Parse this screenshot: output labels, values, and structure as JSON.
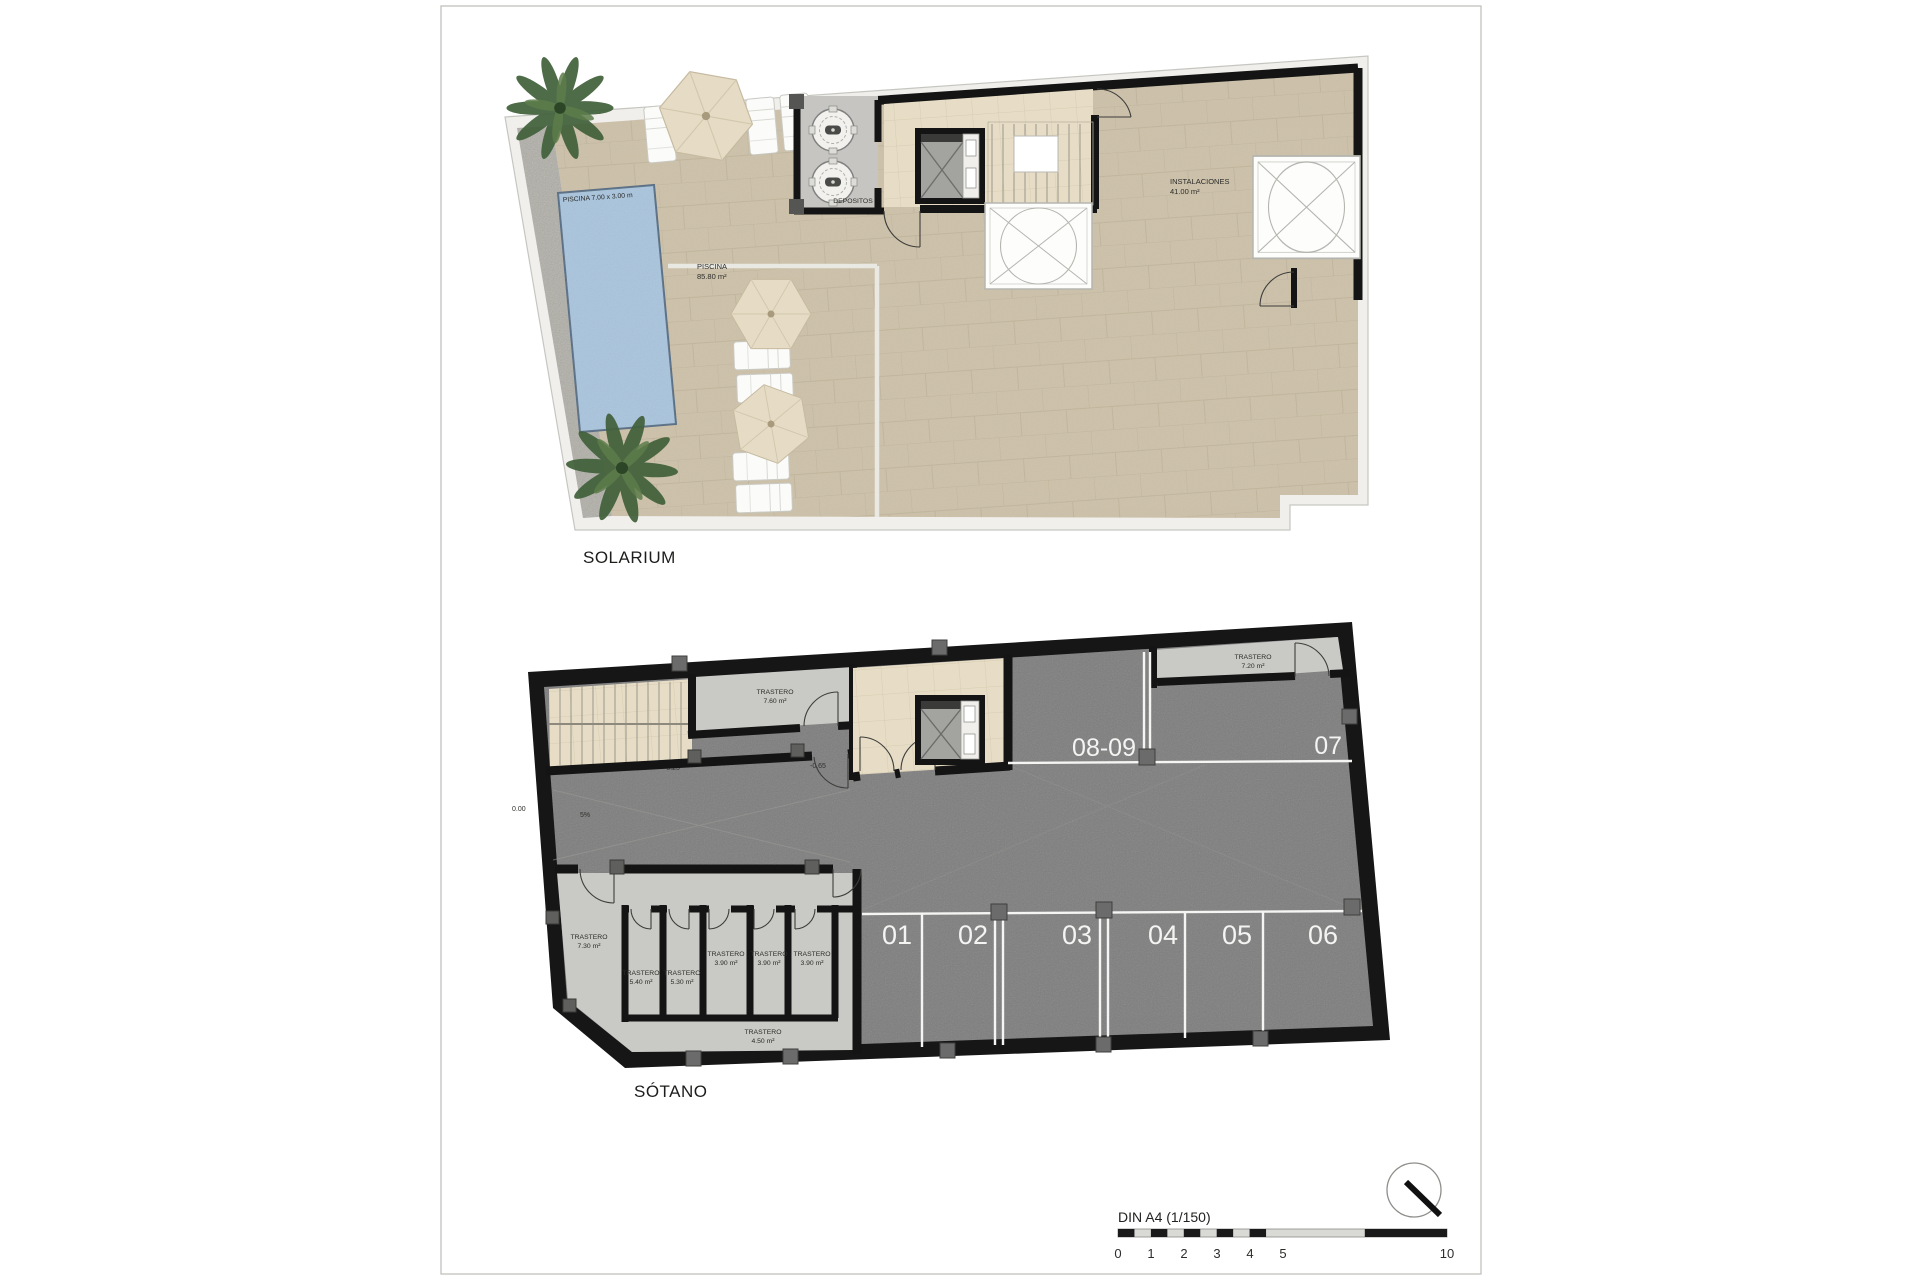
{
  "titles": {
    "solarium": "SOLARIUM",
    "sotano": "SÓTANO"
  },
  "solarium": {
    "pool_dim": "PISCINA 7.00 x 3.00 m",
    "pool": {
      "name": "PISCINA",
      "area": "85.80 m²"
    },
    "depositos": "DEPOSITOS",
    "instalaciones": {
      "name": "INSTALACIONES",
      "area": "41.00 m²"
    }
  },
  "sotano": {
    "levels": {
      "entry": "0.00",
      "upper": "-0.25",
      "lower": "-0.65",
      "ramp_slope": "5%"
    },
    "parking": {
      "p1": "01",
      "p2": "02",
      "p3": "03",
      "p4": "04",
      "p5": "05",
      "p6": "06",
      "p7": "07",
      "p8": "08-09"
    },
    "trasteros": [
      {
        "name": "TRASTERO",
        "area": "7.60 m²"
      },
      {
        "name": "TRASTERO",
        "area": "7.20 m²"
      },
      {
        "name": "TRASTERO",
        "area": "7.30 m²"
      },
      {
        "name": "TRASTERO",
        "area": "5.40 m²"
      },
      {
        "name": "TRASTERO",
        "area": "5.30 m²"
      },
      {
        "name": "TRASTERO",
        "area": "3.90 m²"
      },
      {
        "name": "TRASTERO",
        "area": "3.90 m²"
      },
      {
        "name": "TRASTERO",
        "area": "3.90 m²"
      },
      {
        "name": "TRASTERO",
        "area": "4.50 m²"
      }
    ]
  },
  "footer": {
    "scale_label": "DIN A4 (1/150)",
    "ticks": [
      "0",
      "1",
      "2",
      "3",
      "4",
      "5",
      "10"
    ]
  },
  "colors": {
    "deck": "#cdc1a9",
    "lobby_tile": "#e7ddc6",
    "pool": "#a9c5de",
    "pool_border": "#5b7086",
    "asphalt": "#7d7d7d",
    "wall": "#141414",
    "storage_room": "#c9c9c6",
    "gravel": "#b0aea6",
    "parking_line": "#f5f5f3",
    "parasol": "#e6dcc6",
    "plant": "#41603a"
  }
}
